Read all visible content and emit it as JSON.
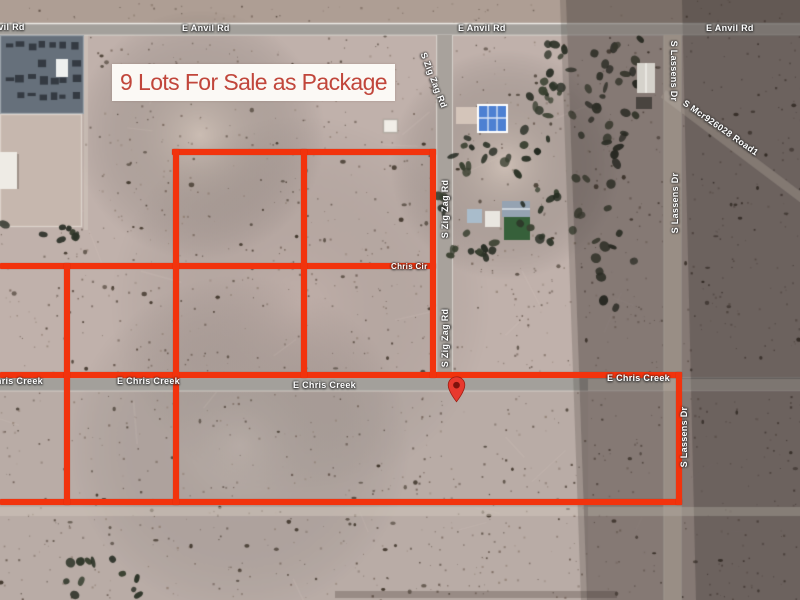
{
  "banner": {
    "text": "9 Lots For Sale as Package",
    "text_color": "#c1463b",
    "bg_color": "#fbf9f5"
  },
  "marker": {
    "meaning": "property-location",
    "fill": "#e8392e",
    "stroke": "#9c1d12",
    "dot": "#7e120c"
  },
  "boundary": {
    "color": "#f2330d",
    "lots_for_sale": 9
  },
  "road_labels": [
    {
      "name": "e-anvil-rd-west",
      "text": "E Anvil Rd"
    },
    {
      "name": "e-anvil-rd-center-1",
      "text": "E Anvil Rd"
    },
    {
      "name": "e-anvil-rd-center-2",
      "text": "E Anvil Rd"
    },
    {
      "name": "e-anvil-rd-east",
      "text": "E Anvil Rd"
    },
    {
      "name": "s-zig-zag-rd-top",
      "text": "S Zig Zag Rd"
    },
    {
      "name": "s-zig-zag-rd-mid",
      "text": "S Zig Zag Rd"
    },
    {
      "name": "s-zig-zag-rd-low",
      "text": "S Zig Zag Rd"
    },
    {
      "name": "s-lassens-dr-top",
      "text": "S Lassens Dr"
    },
    {
      "name": "s-lassens-dr-mid",
      "text": "S Lassens Dr"
    },
    {
      "name": "s-lassens-dr-low",
      "text": "S Lassens Dr"
    },
    {
      "name": "s-mcr926028-road1",
      "text": "S Mcr926028 Road1"
    },
    {
      "name": "chris-cir",
      "text": "Chris Cir"
    },
    {
      "name": "e-chris-creek-west",
      "text": "E Chris Creek"
    },
    {
      "name": "e-chris-creek-1",
      "text": "E Chris Creek"
    },
    {
      "name": "e-chris-creek-2",
      "text": "E Chris Creek"
    },
    {
      "name": "e-chris-creek-east",
      "text": "E Chris Creek"
    }
  ],
  "imagery": {
    "desert": "#c0b1ab",
    "road_gray": "#a3a09b",
    "road_dirt": "#bcb0a6",
    "dirt_track": "#d0c2b6",
    "shadow": "rgba(44,38,34,0.40)",
    "shadow_dark": "rgba(30,26,23,0.24)",
    "tree": "#2c3327",
    "bush": "#2e2519",
    "substation": "#66707b",
    "substation_equipment": "#343a42",
    "yard": "#c6b7ae",
    "white_building": "#eeebe5",
    "solar_roof_blue": "#4d80d2",
    "slate_roof": "#95a3b2",
    "green_roof": "#36603a",
    "shed_blue": "#a9bccb",
    "label_text": "#ffffff"
  }
}
